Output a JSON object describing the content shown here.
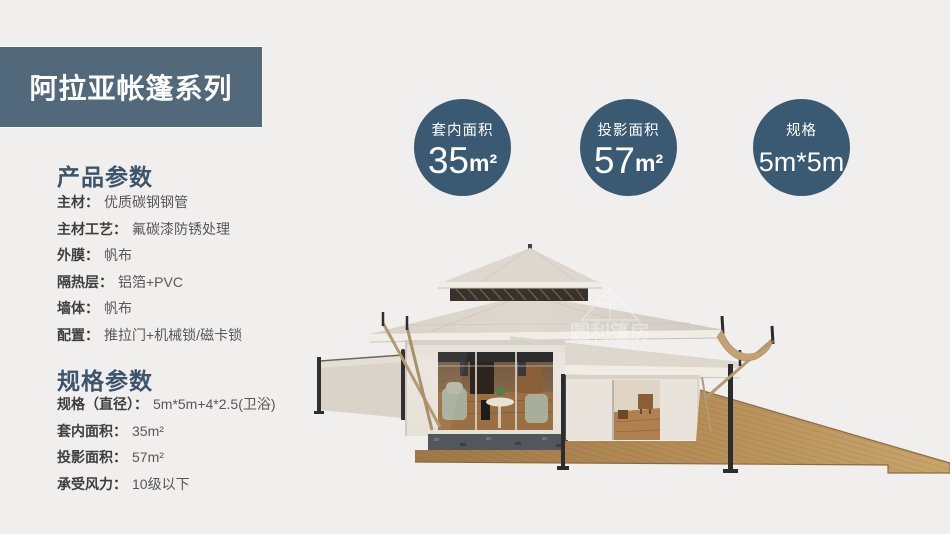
{
  "banner": {
    "title": "阿拉亚帐篷系列"
  },
  "colors": {
    "page_bg": "#f0efee",
    "banner_bg": "#52697c",
    "badge_bg": "#395a72",
    "heading": "#3c556b"
  },
  "product_section": {
    "heading": "产品参数",
    "rows": [
      {
        "label": "主材：",
        "value": "优质碳钢钢管"
      },
      {
        "label": "主材工艺：",
        "value": "氟碳漆防锈处理"
      },
      {
        "label": "外膜：",
        "value": "帆布"
      },
      {
        "label": "隔热层：",
        "value": "铝箔+PVC"
      },
      {
        "label": "墙体：",
        "value": "帆布"
      },
      {
        "label": "配置：",
        "value": "推拉门+机械锁/磁卡锁"
      }
    ]
  },
  "spec_section": {
    "heading": "规格参数",
    "rows": [
      {
        "label": "规格（直径）：",
        "value": "5m*5m+4*2.5(卫浴)"
      },
      {
        "label": "套内面积：",
        "value": "35m²"
      },
      {
        "label": "投影面积：",
        "value": "57m²"
      },
      {
        "label": "承受风力：",
        "value": "10级以下"
      }
    ]
  },
  "badges": [
    {
      "label": "套内面积",
      "value": "35",
      "unit": "m²"
    },
    {
      "label": "投影面积",
      "value": "57",
      "unit": "m²"
    },
    {
      "label": "规格",
      "value": "5m*5m",
      "unit": ""
    }
  ],
  "watermark": {
    "cn": "圆利篷房",
    "en": "YUELI TENT"
  },
  "illustration": {
    "alt": "白色宝塔顶豪华帐篷酒店渲染图（玻璃推拉门、侧遮阳板、木地台）"
  }
}
